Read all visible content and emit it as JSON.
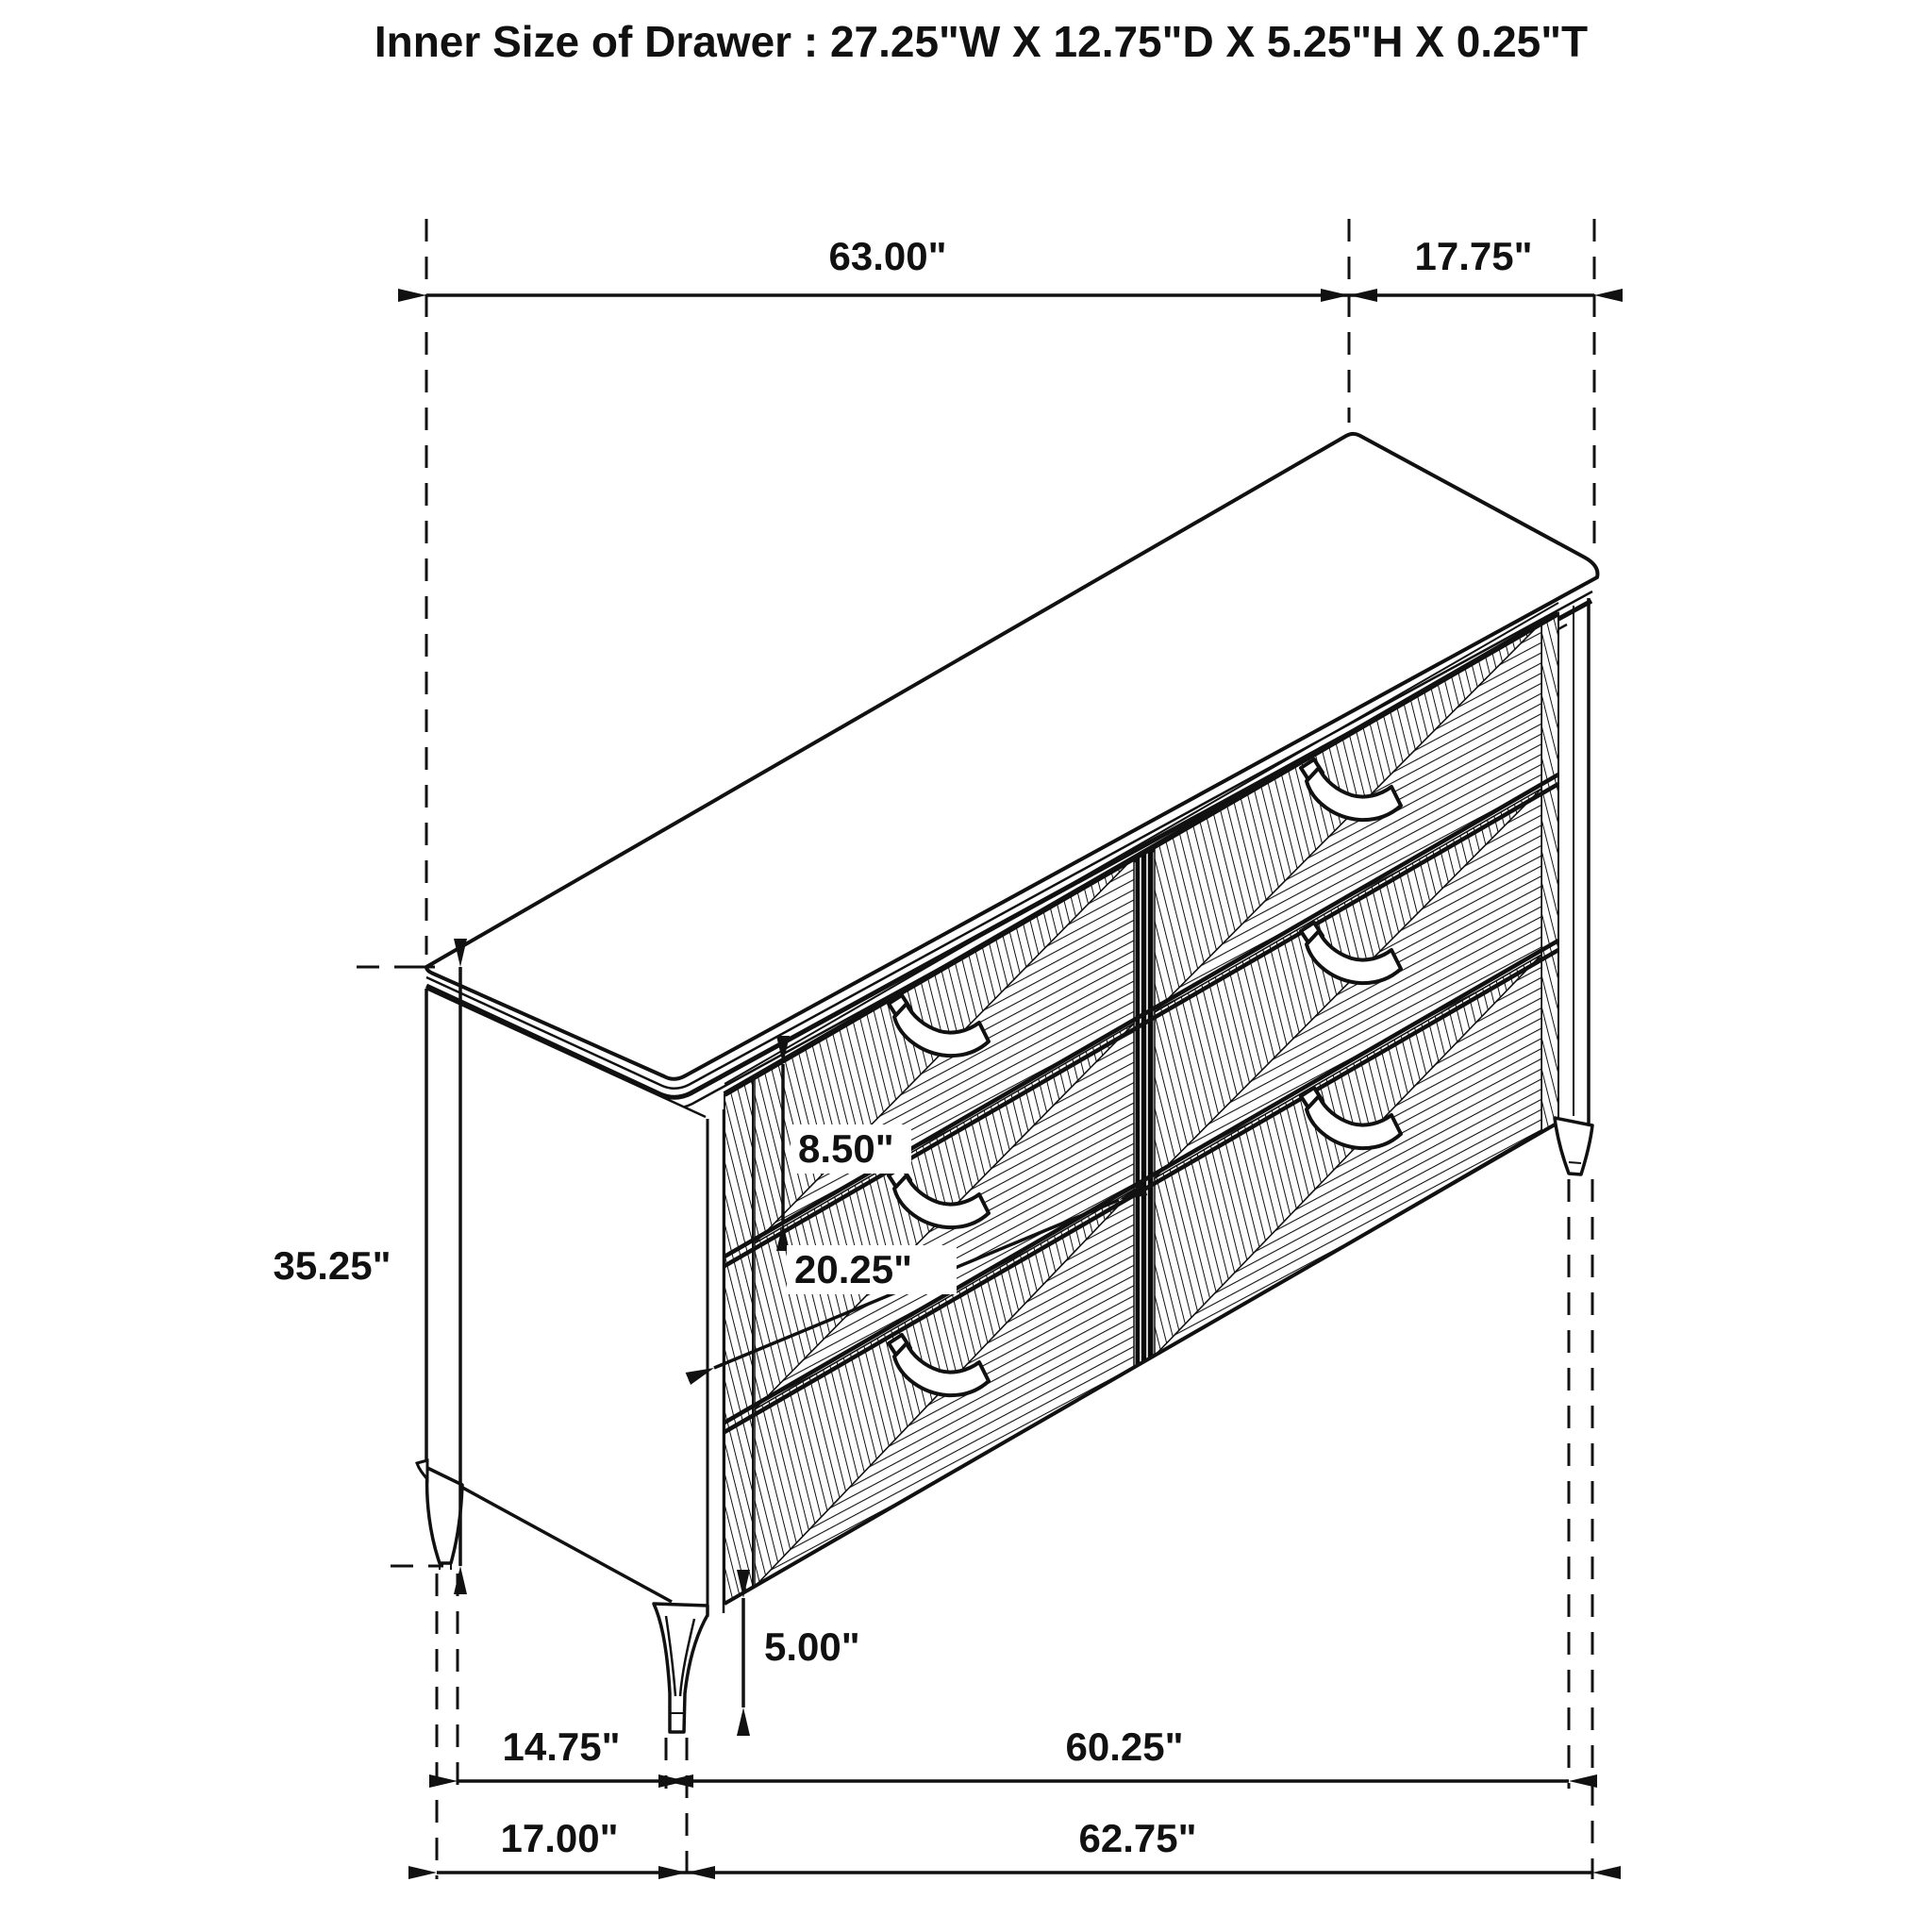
{
  "title": "Inner Size of Drawer : 27.25\"W X 12.75\"D X 5.25\"H X 0.25\"T",
  "dimensions": {
    "overall_width": "63.00\"",
    "overall_depth": "17.75\"",
    "overall_height": "35.25\"",
    "drawer_front_height": "8.50\"",
    "drawer_front_width": "20.25\"",
    "leg_height": "5.00\"",
    "front_leg_inset": "14.75\"",
    "leg_span_width": "60.25\"",
    "base_depth": "17.00\"",
    "base_width": "62.75\""
  }
}
